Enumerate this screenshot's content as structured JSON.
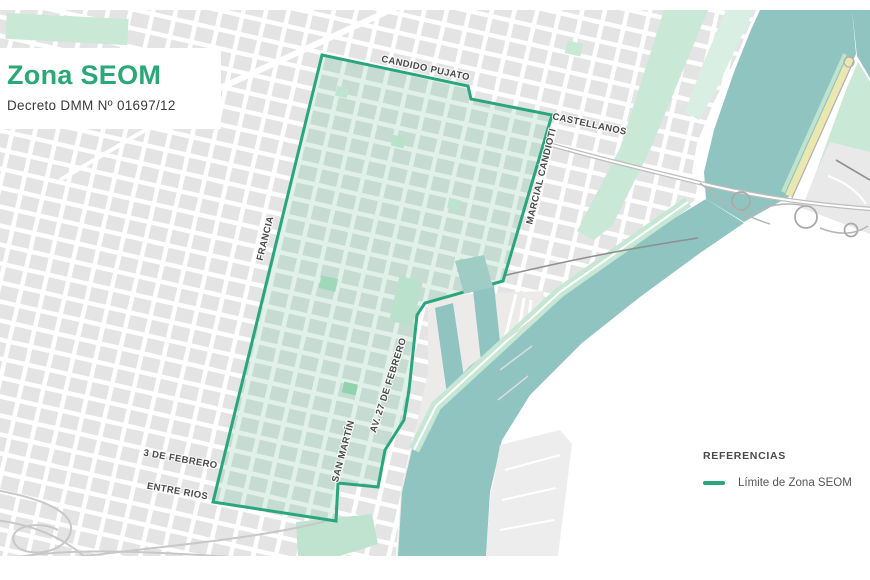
{
  "title_card": {
    "heading": "Zona SEOM",
    "subheading": "Decreto DMM Nº 01697/12"
  },
  "legend": {
    "heading": "REFERENCIAS",
    "items": [
      {
        "label": "Límite de Zona SEOM",
        "swatch_color": "#29a67e"
      }
    ]
  },
  "map": {
    "street_labels": [
      {
        "id": "candido-pujato",
        "text": "CANDIDO PUJATO"
      },
      {
        "id": "castellanos",
        "text": "CASTELLANOS"
      },
      {
        "id": "marcial-candioti",
        "text": "MARCIAL CANDIOTI"
      },
      {
        "id": "francia",
        "text": "FRANCIA"
      },
      {
        "id": "san-martin",
        "text": "SAN MARTÍN"
      },
      {
        "id": "av-27-de-febrero",
        "text": "AV. 27 DE FEBRERO"
      },
      {
        "id": "3-de-febrero",
        "text": "3 DE FEBRERO"
      },
      {
        "id": "entre-rios",
        "text": "ENTRE RIOS"
      }
    ],
    "colors": {
      "zone_boundary": "#29a67e",
      "zone_street": "#e1f1e9",
      "zone_block": "#c6dcd2",
      "urban_block": "#e4e4e4",
      "water": "#8fc4c1",
      "park": "#c9e8d6",
      "beach": "#ebe7ae",
      "title_green": "#2aa877"
    }
  }
}
